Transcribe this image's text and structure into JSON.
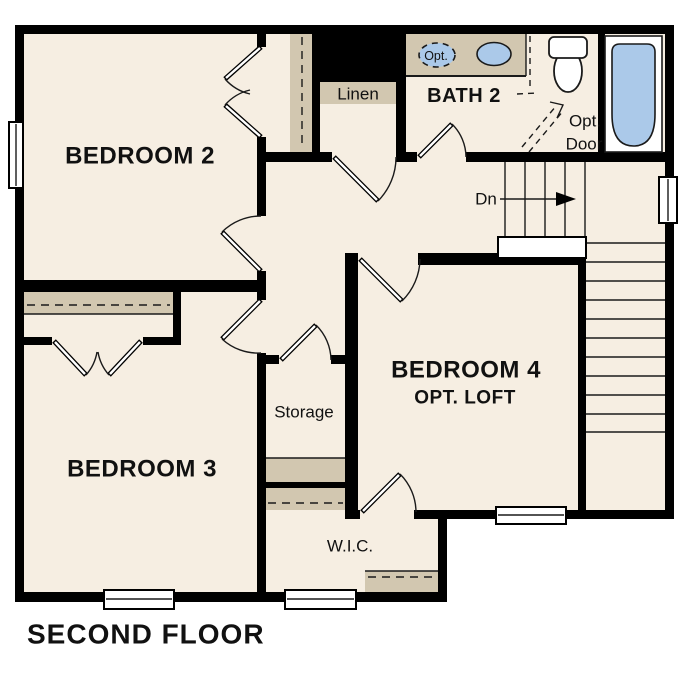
{
  "title": "SECOND FLOOR",
  "colors": {
    "floor": "#f6eee2",
    "shelf": "#d2c7b0",
    "fixture": "#abc9e9",
    "wall": "#000000",
    "line": "#1a1a1a"
  },
  "rooms": {
    "bedroom2": {
      "label": "BEDROOM 2"
    },
    "bedroom3": {
      "label": "BEDROOM 3"
    },
    "bedroom4": {
      "label": "BEDROOM 4",
      "sublabel": "OPT. LOFT"
    },
    "bath2": {
      "label": "BATH 2"
    },
    "linen": {
      "label": "Linen"
    },
    "storage": {
      "label": "Storage"
    },
    "wic": {
      "label": "W.I.C."
    }
  },
  "stairs": {
    "down_label": "Dn"
  },
  "annotations": {
    "opt_door_line1": "Opt.",
    "opt_door_line2": "Door",
    "opt_sink": "Opt."
  }
}
